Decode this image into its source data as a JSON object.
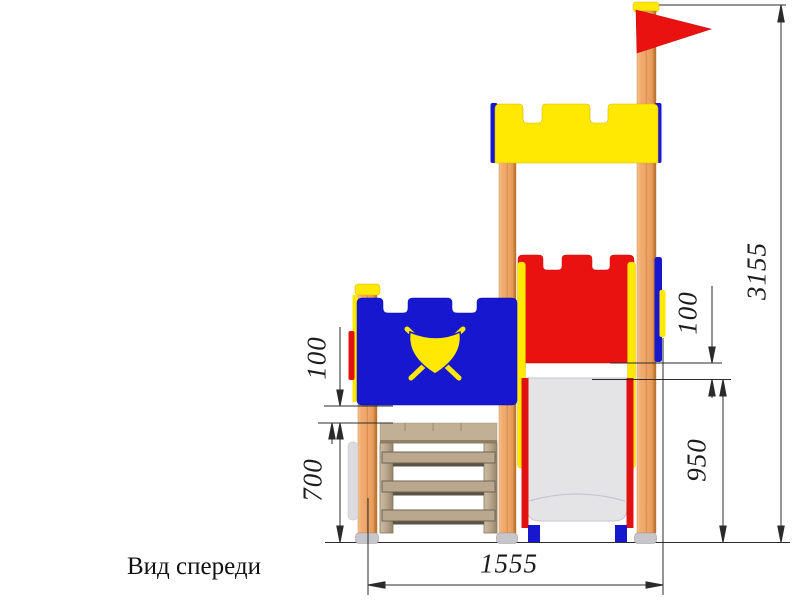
{
  "caption": "Вид спереди",
  "dimensions": {
    "overall_height_mm": "3155",
    "left_panel_gap_mm": "100",
    "right_panel_gap_mm": "100",
    "slide_platform_height_mm": "950",
    "lower_platform_height_mm": "700",
    "overall_width_mm": "1555"
  },
  "colors": {
    "panel_blue": "#1717d0",
    "panel_red": "#ea1111",
    "panel_yellow": "#ffe802",
    "wood_post": "#efa568",
    "platform_tan": "#c1b096",
    "slide_gray": "#e4e4e7",
    "cap_gray": "#c7c7cb",
    "dimension_line": "#2b2b2b"
  }
}
